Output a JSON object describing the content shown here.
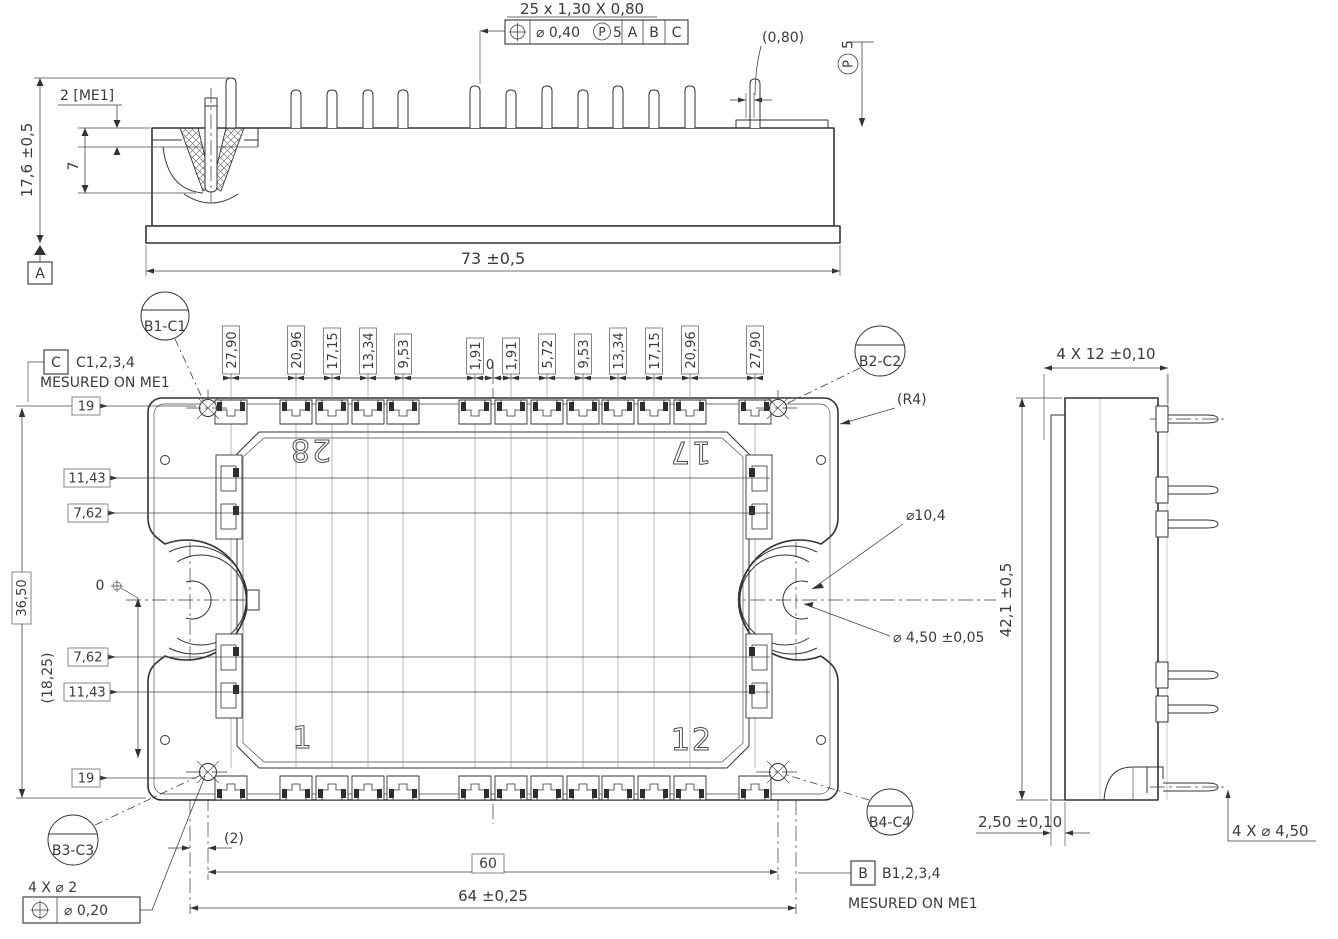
{
  "top_view": {
    "pin_row_note": "25 x 1,30 X 0,80",
    "fcf": {
      "tolerance": "⌀ 0,40",
      "projected_symbol": "P",
      "projected_value": "5",
      "datum_1": "A",
      "datum_2": "B",
      "datum_3": "C"
    },
    "step_dim": "(0,80)",
    "projected_zone": {
      "symbol": "P",
      "value": "5"
    },
    "me1_dim": "2 [ME1]",
    "height_dim": "17,6 ±0,5",
    "insert_depth_dim": "7",
    "datum_a": "A",
    "width_dim": "73 ±0,5"
  },
  "plan_view": {
    "balloon_b1c1": "B1-C1",
    "balloon_b2c2": "B2-C2",
    "balloon_b3c3": "B3-C3",
    "balloon_b4c4": "B4-C4",
    "datum_c": {
      "label": "C",
      "features": "C1,2,3,4",
      "note": "MESURED ON ME1"
    },
    "datum_b": {
      "label": "B",
      "features": "B1,2,3,4",
      "note": "MESURED ON ME1"
    },
    "pin_pitch_chain": [
      "27,90",
      "20,96",
      "17,15",
      "13,34",
      "9,53",
      "1,91",
      "0",
      "1,91",
      "5,72",
      "9,53",
      "13,34",
      "17,15",
      "20,96",
      "27,90"
    ],
    "row_chain": [
      "19",
      "11,43",
      "7,62",
      "0",
      "7,62",
      "11,43",
      "19"
    ],
    "row_ref": "(18,25)",
    "height_ref": "36,50",
    "corner_radius": "(R4)",
    "boss_dia": "⌀10,4",
    "hole_dia": "⌀ 4,50 ±0,05",
    "offset_dim": "(2)",
    "hole_span_dim": "60",
    "mount_span_dim": "64 ±0,25",
    "corner_holes_note": "4 X ⌀ 2",
    "fcf2_tolerance": "⌀ 0,20",
    "pin28": "28",
    "pin17": "17",
    "pin1": "1",
    "pin12": "12"
  },
  "side_view": {
    "pin_length_dim": "4 X 12 ±0,10",
    "height_dim": "42,1 ±0,5",
    "flange_dim": "2,50 ±0,10",
    "pin_dia_dim": "4 X ⌀ 4,50"
  },
  "colors": {
    "line": "#333333",
    "background": "#ffffff"
  }
}
